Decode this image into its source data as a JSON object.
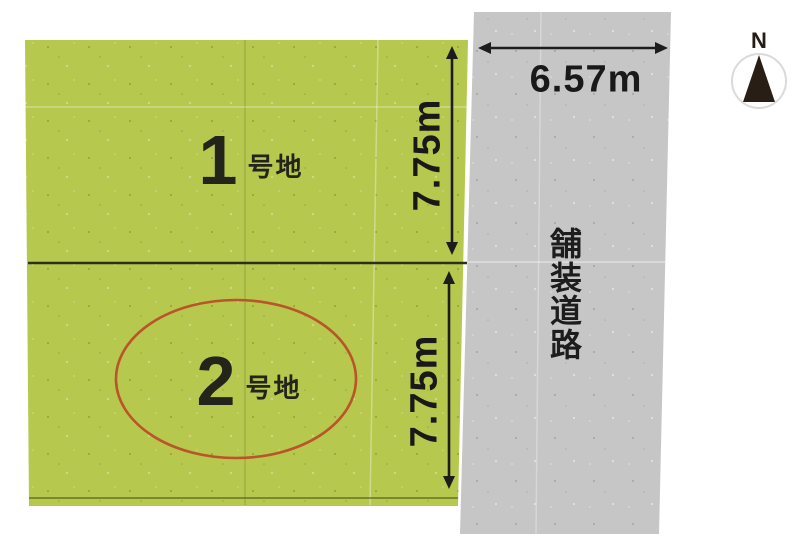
{
  "plots": [
    {
      "number": "1",
      "suffix": "号地",
      "depth": "7.75m",
      "highlighted": false
    },
    {
      "number": "2",
      "suffix": "号地",
      "depth": "7.75m",
      "highlighted": true
    }
  ],
  "road": {
    "name": "舗装道路",
    "width": "6.57m"
  },
  "compass": {
    "north": "N"
  },
  "colors": {
    "plot_fill": "#b6c84d",
    "road_fill": "#c6c6c6",
    "highlight_ellipse": "#bb5428",
    "divider": "#2c2e1e",
    "ink": "#1d1d1d"
  }
}
